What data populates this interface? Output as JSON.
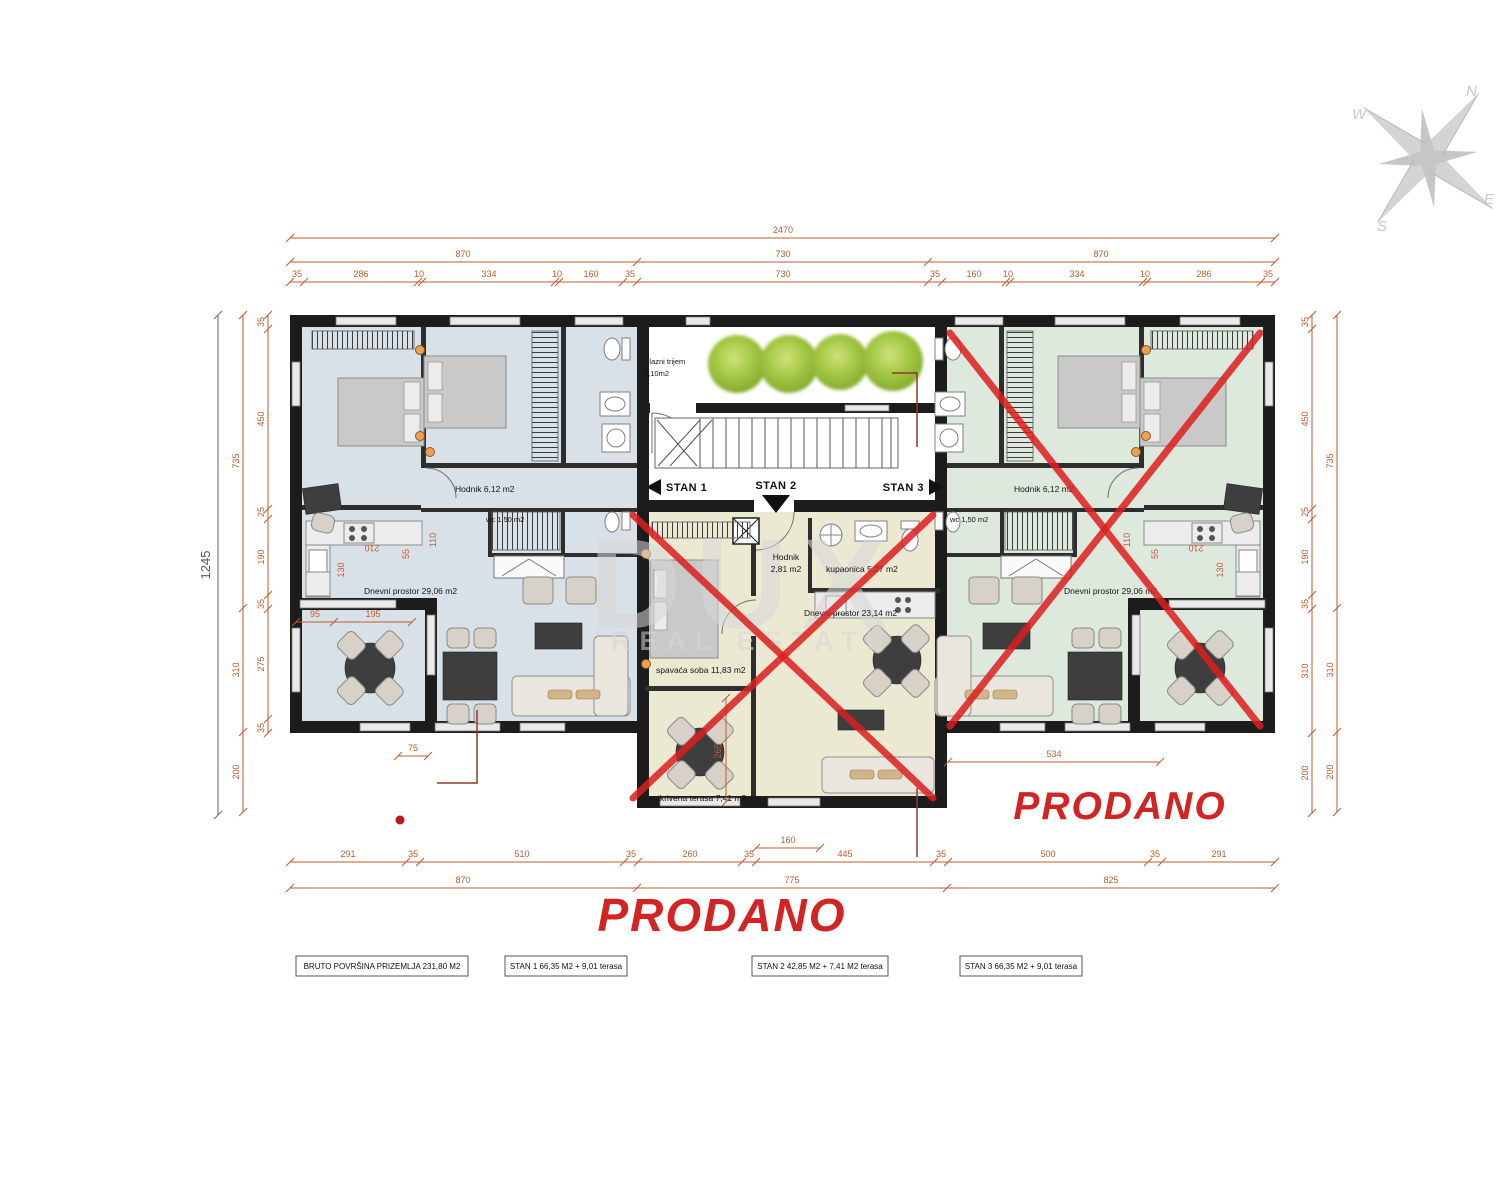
{
  "compass": {
    "n": "N",
    "e": "E",
    "s": "S",
    "w": "W"
  },
  "watermark": {
    "brand": "DUX",
    "sub": "REAL ESTATE"
  },
  "sold_labels": {
    "center": "PRODANO",
    "right": "PRODANO"
  },
  "apartments": {
    "stan1_arrow": "STAN 1",
    "stan2_arrow": "STAN 2",
    "stan3_arrow": "STAN 3",
    "porch": {
      "name": "Ulazni trijem",
      "area": "2,10m2"
    },
    "stan1": {
      "hodnik": "Hodnik 6,12 m2",
      "wc": "wc 1,50 m2",
      "dnevni": "Dnevni prostor 29,06 m2"
    },
    "stan2": {
      "hodnik_name": "Hodnik",
      "hodnik_area": "2,81 m2",
      "kupaonica": "kupaonica 5,27 m2",
      "dnevni": "Dnevni prostor 23,14 m2",
      "spavaca": "spavaća soba 11,83 m2",
      "terasa": "natkrivena terasa 7,41 m2"
    },
    "stan3": {
      "hodnik": "Hodnik 6,12 m2",
      "wc": "wc 1,50 m2",
      "dnevni": "Dnevni prostor 29,06 m2"
    }
  },
  "dims": {
    "top_total": "2470",
    "top_mid": [
      "870",
      "730",
      "870"
    ],
    "top_detail": [
      "35",
      "286",
      "10",
      "334",
      "10",
      "160",
      "35",
      "730",
      "35",
      "160",
      "10",
      "334",
      "10",
      "286",
      "35"
    ],
    "bottom_detail": [
      "291",
      "35",
      "510",
      "35",
      "260",
      "35",
      "445",
      "35",
      "500",
      "35",
      "291"
    ],
    "bottom_mid": [
      "870",
      "775",
      "825"
    ],
    "left_total": "1245",
    "left_mid": [
      "735",
      "310",
      "200"
    ],
    "left_detail": [
      "35",
      "450",
      "25",
      "190",
      "35",
      "275",
      "35"
    ],
    "right_detail": [
      "35",
      "450",
      "25",
      "190",
      "35",
      "310",
      "200"
    ],
    "right_mid": [
      "735",
      "310",
      "200"
    ],
    "terrace_left": [
      "95",
      "195"
    ],
    "terrace_left_small": "75",
    "stan2_terrace_h": "265",
    "stan2_door": "160",
    "stan3_living": "534",
    "kitchen": {
      "a": "210",
      "b": "110",
      "c": "55",
      "d": "130"
    }
  },
  "footer": {
    "bruto": "BRUTO POVRŠINA PRIZEMLJA 231,80 M2",
    "stan1": "STAN 1 66,35 M2 + 9,01 terasa",
    "stan2": "STAN 2 42,85 M2 + 7,41 M2 terasa",
    "stan3": "STAN 3 66,35 M2 + 9,01 terasa"
  },
  "colors": {
    "stan1_floor": "#d9e1e8",
    "stan2_floor": "#ece9d3",
    "stan3_floor": "#dde9dd",
    "wall": "#1c1c1c",
    "dimension": "#bf5b2e",
    "sold_red": "#d32424",
    "cross_red": "#dd1f1f",
    "tree_green": "#a3c743",
    "watermark_gray": "#d7d7d7"
  }
}
